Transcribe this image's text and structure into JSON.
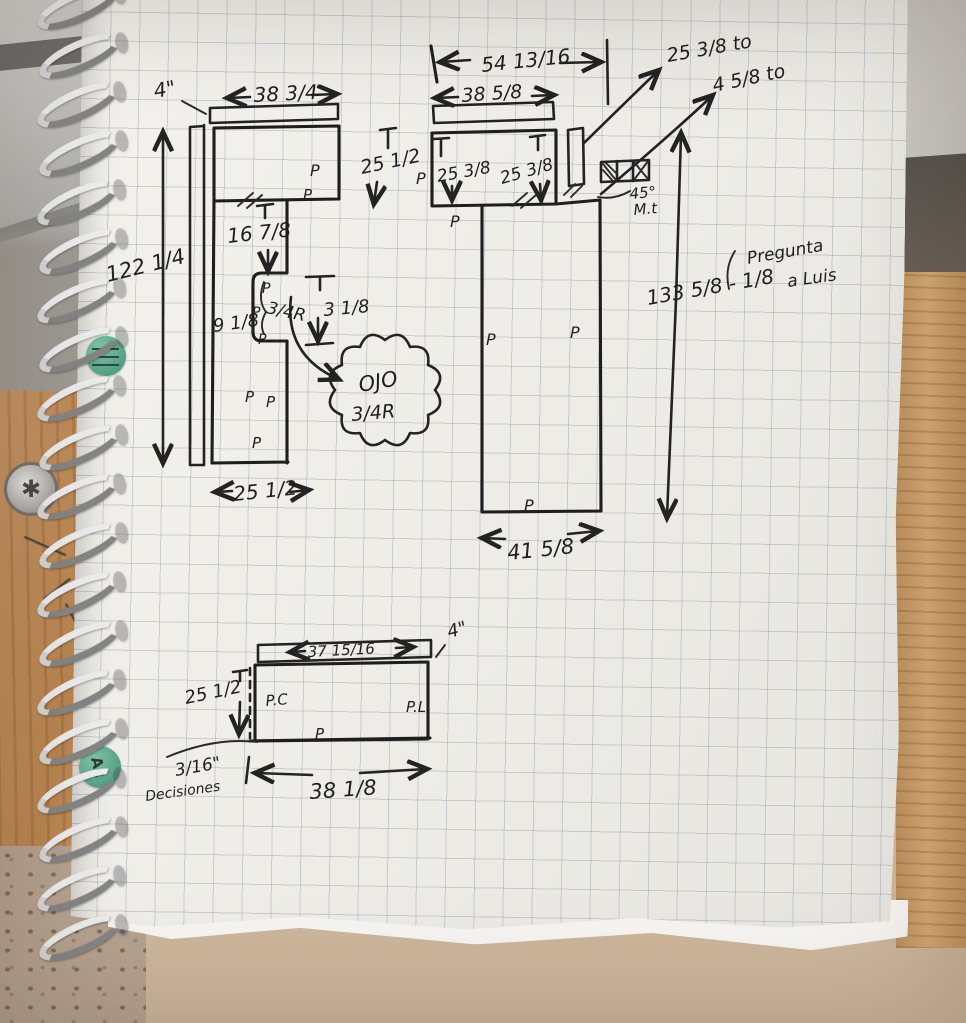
{
  "stickers": {
    "dot_bottom": "Ac"
  },
  "left_panel": {
    "strip_thickness": "4\"",
    "strip_width": "38 3/4",
    "total_height": "122 1/4",
    "notch_offset": "16 7/8",
    "notch_width": "9 1/8",
    "corner_radius": "3/4R",
    "notch_height": "3 1/8",
    "bottom_width": "25 1/2",
    "mark": "P"
  },
  "callout": {
    "title": "OJO",
    "radius": "3/4R"
  },
  "middle_panel": {
    "overall_width": "54 13/16",
    "note_top": "25 3/8 to",
    "note_bottom": "4 5/8 to",
    "strip_width": "38 5/8",
    "side_height": "25 1/2",
    "inner_left_height": "25 3/8",
    "inner_right_height": "25 3/8",
    "miter_angle": "45°",
    "miter_label": "M.t",
    "overall_height": "133 5/8 - 1/8",
    "note_question_1": "Pregunta",
    "note_question_2": "a Luis",
    "bottom_width": "41 5/8",
    "mark": "P"
  },
  "bottom_panel": {
    "strip_width": "37 15/16",
    "strip_thickness": "4\"",
    "side_height": "25 1/2",
    "mark_left": "P.C",
    "mark_right": "P.L",
    "mark_bottom": "P",
    "offset": "3/16\"",
    "note": "Decisiones",
    "bottom_width": "38 1/8"
  }
}
